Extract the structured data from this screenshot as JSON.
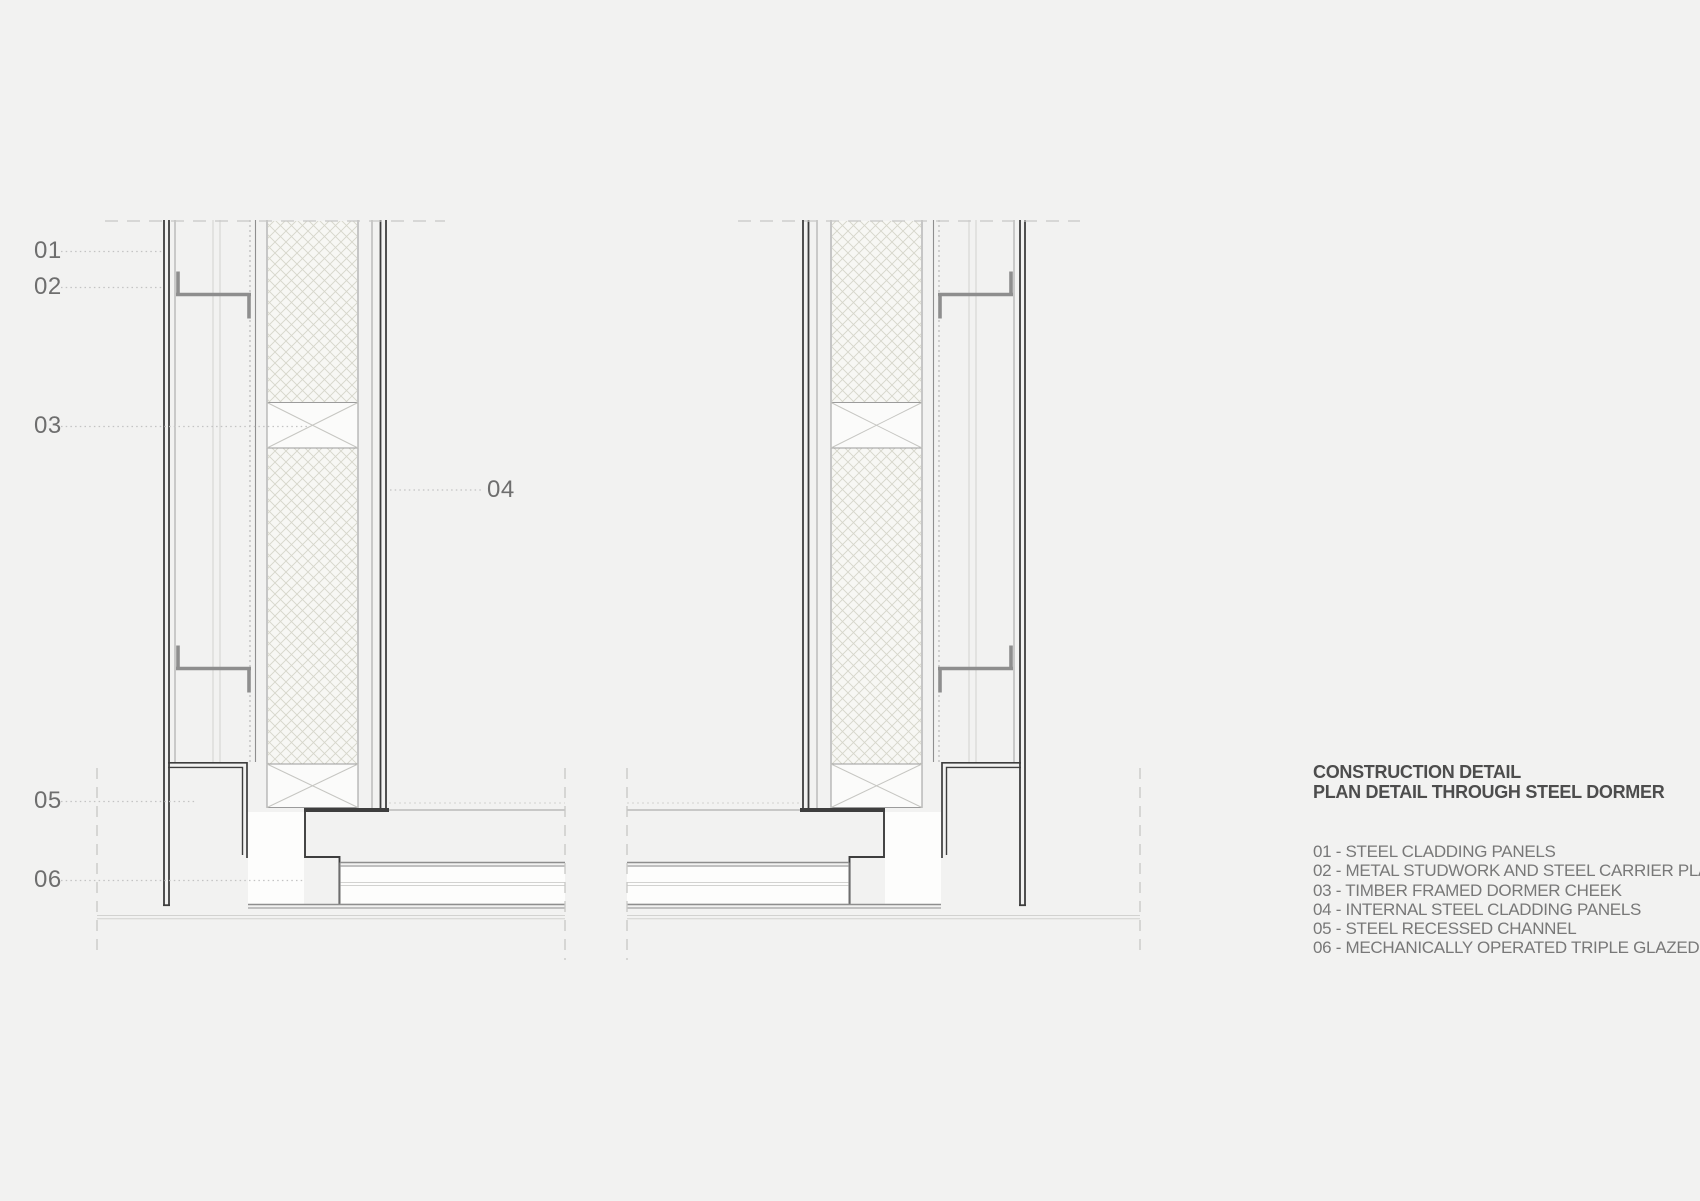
{
  "drawing": {
    "callouts": [
      {
        "num": "01"
      },
      {
        "num": "02"
      },
      {
        "num": "03"
      },
      {
        "num": "04"
      },
      {
        "num": "05"
      },
      {
        "num": "06"
      }
    ]
  },
  "legend": {
    "title_line1": "CONSTRUCTION DETAIL",
    "title_line2": "PLAN DETAIL THROUGH STEEL DORMER",
    "items": [
      {
        "label": "01 - STEEL CLADDING PANELS"
      },
      {
        "label": "02 - METAL STUDWORK AND STEEL CARRIER PLATE"
      },
      {
        "label": "03 - TIMBER FRAMED DORMER CHEEK"
      },
      {
        "label": "04 - INTERNAL STEEL CLADDING PANELS"
      },
      {
        "label": "05 - STEEL RECESSED CHANNEL"
      },
      {
        "label": "06 - MECHANICALLY OPERATED TRIPLE GLAZED WINDOW"
      }
    ]
  },
  "colors": {
    "background": "#f2f2f1",
    "ink": "#3e3e3e",
    "mid": "#8e8e8e",
    "light": "#aeaeae",
    "faint": "#d2d2d0",
    "hatch_line": "#d6d6cb",
    "hatch_bg": "#f7f7f4",
    "box_border": "#9b9b9b",
    "box_diag": "#c6c6c2",
    "box_fill": "#fbfbfa",
    "white": "#fdfdfc",
    "leader": "#c3c3c3",
    "callout_text": "#6e6e6e",
    "legend_title_text": "#4d4d4d",
    "legend_item_text": "#787878",
    "dash_line": "#c7c7c5"
  }
}
